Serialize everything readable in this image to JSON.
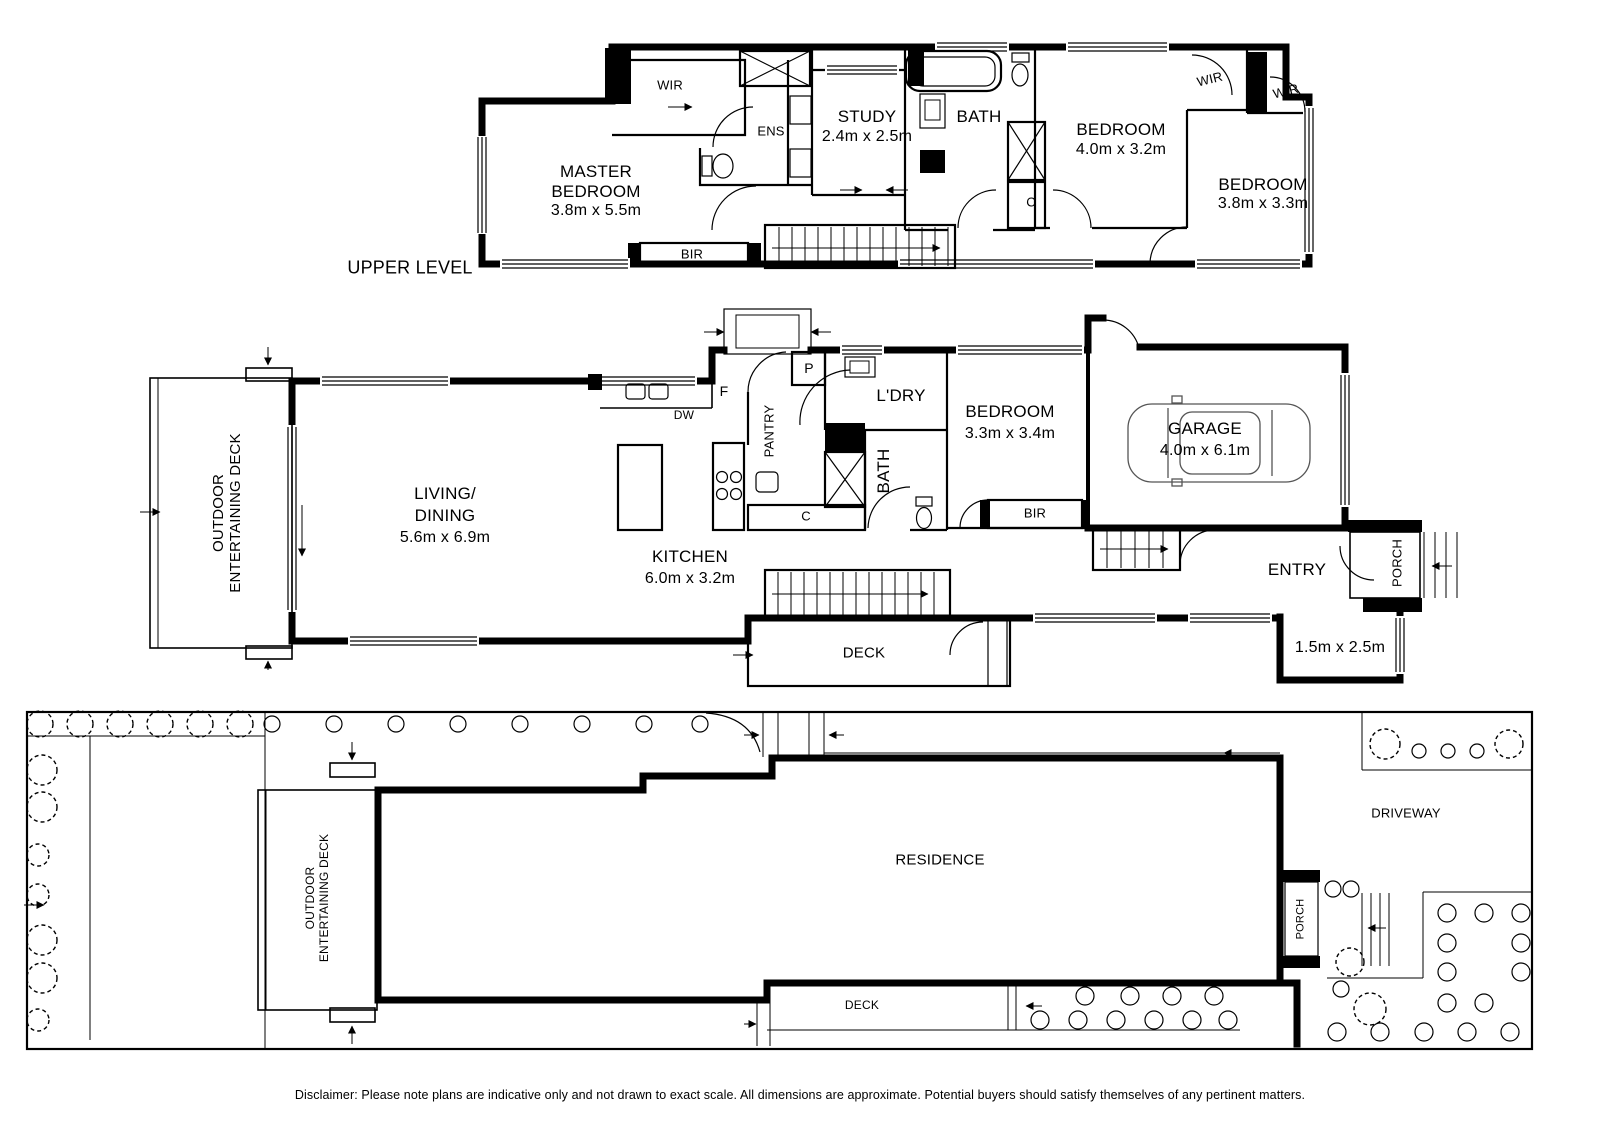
{
  "upper": {
    "caption": "UPPER LEVEL",
    "master_l1": "MASTER",
    "master_l2": "BEDROOM",
    "master_dims": "3.8m x 5.5m",
    "wir": "WIR",
    "ens": "ENS",
    "study": "STUDY",
    "study_dims": "2.4m x 2.5m",
    "bath": "BATH",
    "bed2": "BEDROOM",
    "bed2_dims": "4.0m x 3.2m",
    "wir2": "WIR",
    "wir3": "WIR",
    "bed3": "BEDROOM",
    "bed3_dims": "3.8m x 3.3m",
    "cupboard": "C",
    "bir": "BIR"
  },
  "ground": {
    "odeck_l1": "OUTDOOR",
    "odeck_l2": "ENTERTAINING DECK",
    "living_l1": "LIVING/",
    "living_l2": "DINING",
    "living_dims": "5.6m x 6.9m",
    "kitchen": "KITCHEN",
    "kitchen_dims": "6.0m x 3.2m",
    "fridge": "F",
    "dishwasher": "DW",
    "pantry": "PANTRY",
    "p": "P",
    "laundry": "L'DRY",
    "cupboard": "C",
    "bath": "BATH",
    "bed": "BEDROOM",
    "bed_dims": "3.3m x 3.4m",
    "bir": "BIR",
    "garage": "GARAGE",
    "garage_dims": "4.0m x 6.1m",
    "entry": "ENTRY",
    "porch": "PORCH",
    "deck": "DECK",
    "courtyard_dims": "1.5m x 2.5m"
  },
  "site": {
    "odeck_l1": "OUTDOOR",
    "odeck_l2": "ENTERTAINING DECK",
    "residence": "RESIDENCE",
    "driveway": "DRIVEWAY",
    "porch": "PORCH",
    "deck": "DECK"
  },
  "disclaimer": "Disclaimer: Please note plans are indicative only and not drawn to exact scale. All dimensions are approximate. Potential buyers should satisfy themselves of any pertinent matters."
}
